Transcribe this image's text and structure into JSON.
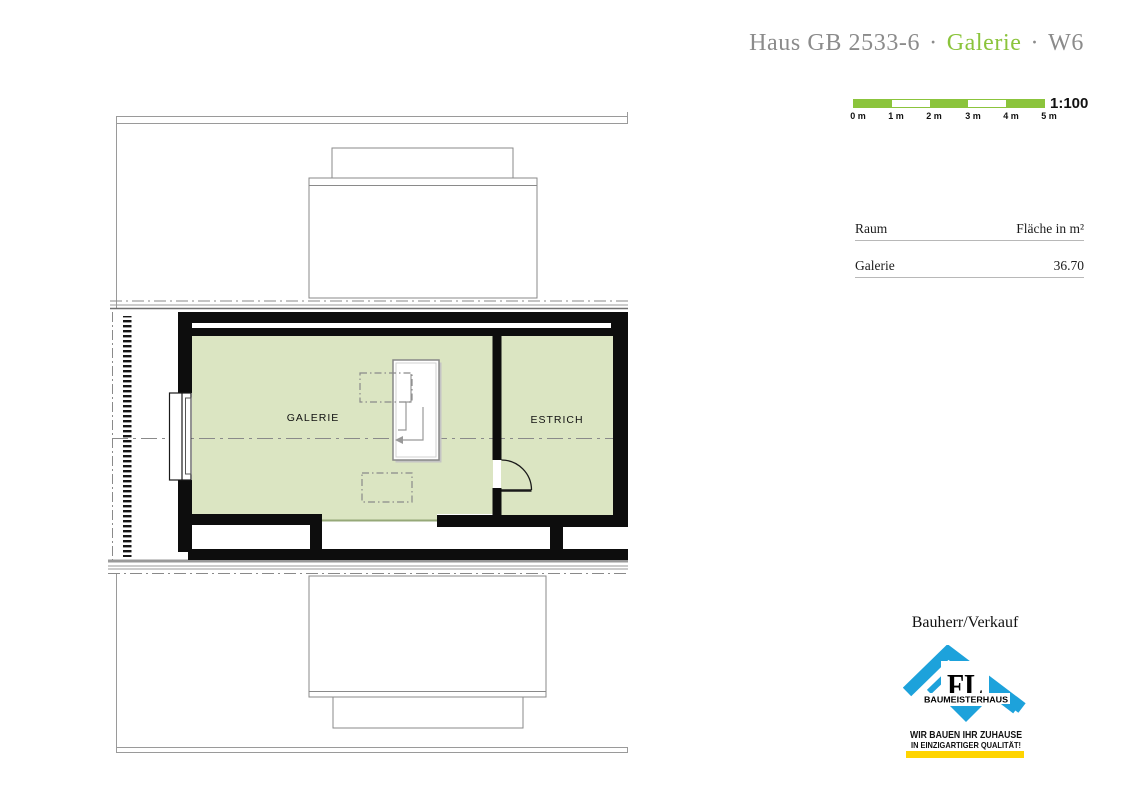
{
  "header": {
    "title_prefix": "Haus GB 2533-6",
    "separator": "·",
    "title_highlight": "Galerie",
    "title_suffix": "W6",
    "gray_color": "#8b8b8b",
    "accent_green": "#8bc43c"
  },
  "scale_bar": {
    "ratio_label": "1:100",
    "tick_labels": [
      "0 m",
      "1 m",
      "2 m",
      "3 m",
      "4 m",
      "5 m"
    ],
    "bar_green": "#8bc43c"
  },
  "area_table": {
    "col_room": "Raum",
    "col_area": "Fläche in m²",
    "rows": [
      {
        "room": "Galerie",
        "area": "36.70"
      }
    ]
  },
  "floor_plan": {
    "rooms": [
      {
        "label": "GALERIE"
      },
      {
        "label": "ESTRICH"
      }
    ],
    "room_fill_color": "#dbe5c2",
    "wall_color": "#0d0d0d"
  },
  "footer": {
    "heading": "Bauherr/Verkauf",
    "logo": {
      "initials": "FL",
      "brand": "BAUMEISTERHAUS",
      "slogan_line1": "WIR BAUEN IHR ZUHAUSE",
      "slogan_line2": "IN EINZIGARTIGER QUALITÄT!",
      "blue": "#1da2db",
      "yellow": "#ffd400"
    }
  }
}
